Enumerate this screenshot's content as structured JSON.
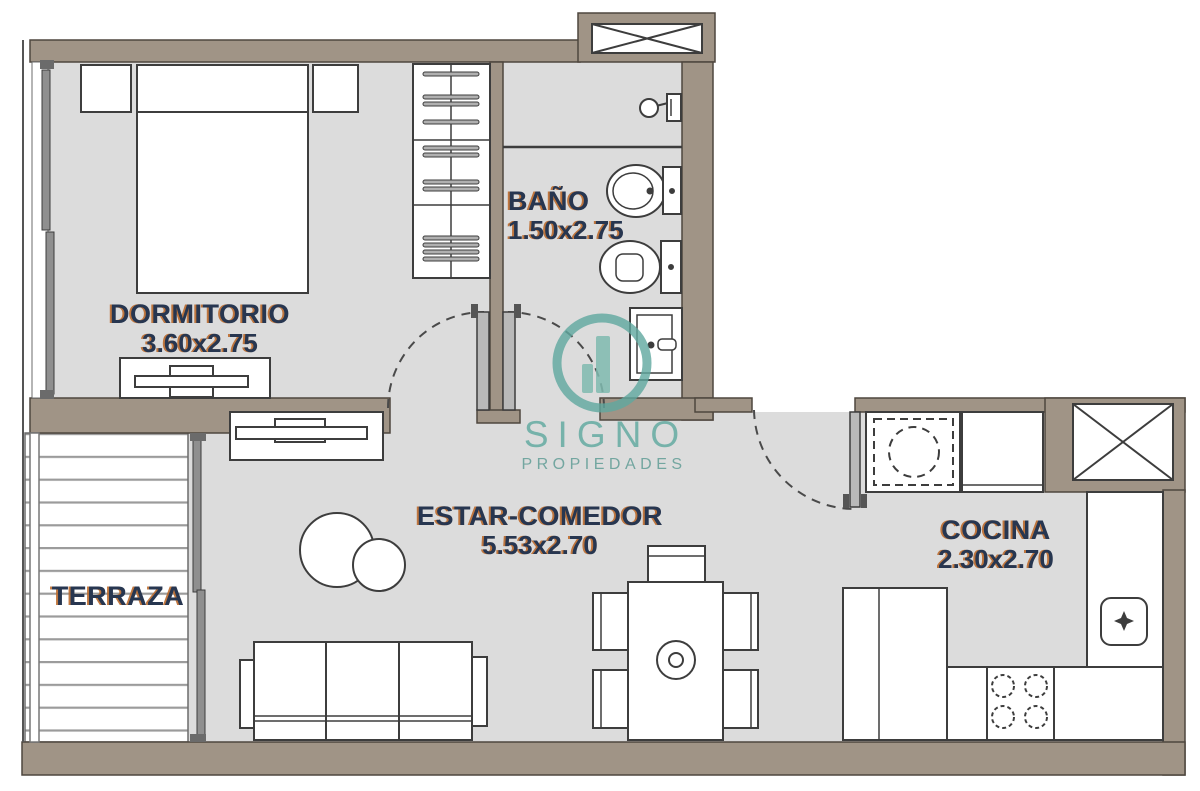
{
  "brand": {
    "name": "SIGNO",
    "tagline": "PROPIEDADES"
  },
  "rooms": {
    "dormitorio": {
      "label": "DORMITORIO",
      "dims": "3.60x2.75"
    },
    "bano": {
      "label": "BAÑO",
      "dims": "1.50x2.75"
    },
    "estar": {
      "label": "ESTAR-COMEDOR",
      "dims": "5.53x2.70"
    },
    "cocina": {
      "label": "COCINA",
      "dims": "2.30x2.70"
    },
    "terraza": {
      "label": "TERRAZA"
    }
  },
  "colors": {
    "wall": "#a09486",
    "floor": "#dcdcdc",
    "accent_teal": "#5FA89F",
    "logo_bar_teal": "#7FBAAF",
    "label_navy": "#273650",
    "label_shadow_orange": "#BB6A2C"
  }
}
